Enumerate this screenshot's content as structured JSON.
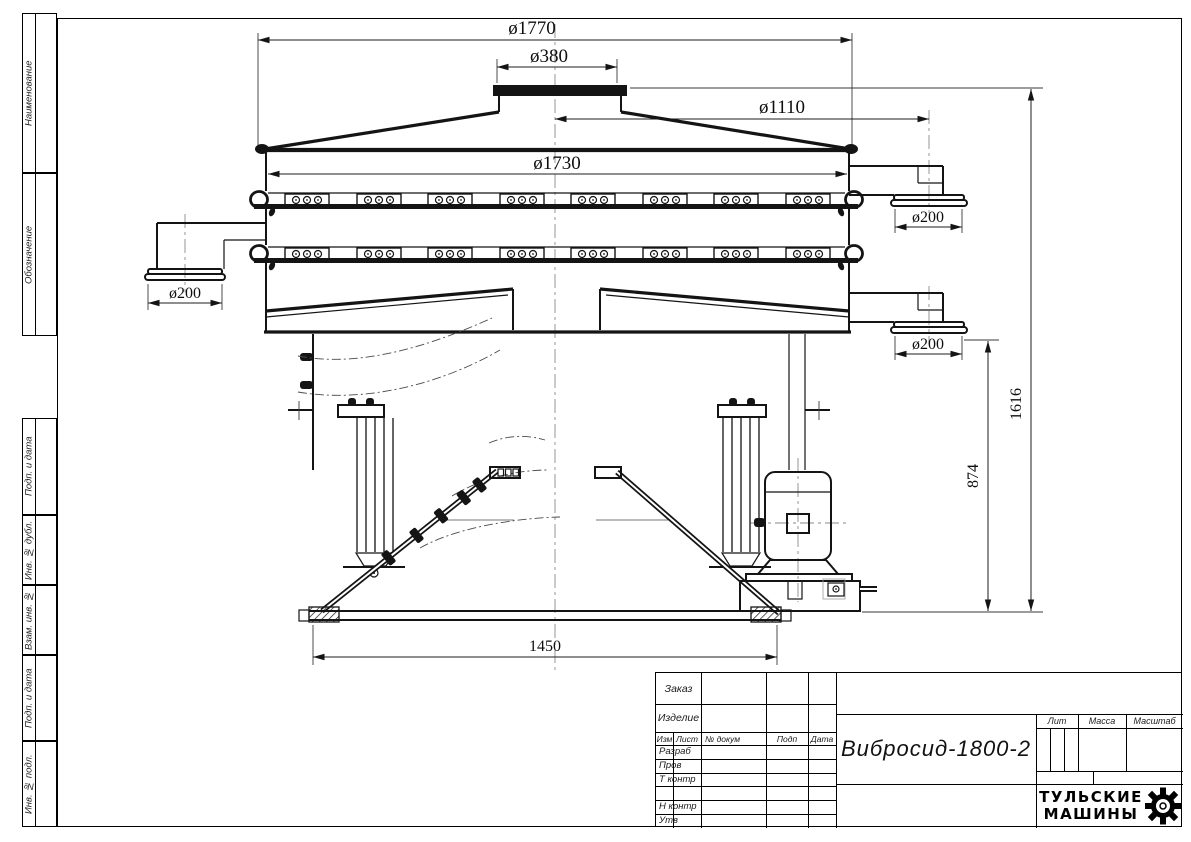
{
  "sidebar": {
    "labels": [
      "Наименование",
      "Обозначение",
      "Подп. и дата",
      "Инв. № дубл.",
      "Взам. инв. №",
      "Подп. и дата",
      "Инв. № подл."
    ]
  },
  "dims": {
    "top_flange": "ø1770",
    "inlet": "ø380",
    "outlet_circle": "ø1110",
    "body": "ø1730",
    "outlet_left": "ø200",
    "outlet_right_top": "ø200",
    "outlet_right_bottom": "ø200",
    "height_total": "1616",
    "height_base": "874",
    "base_width": "1450"
  },
  "title_block": {
    "order_label": "Заказ",
    "product_label": "Изделие",
    "cols": {
      "izm": "Изм",
      "list": "Лист",
      "dokum": "№ докум",
      "podp": "Подп",
      "data": "Дата"
    },
    "rows": [
      "Разраб",
      "Пров",
      "Т контр",
      "",
      "Н контр",
      "Утв"
    ],
    "doc_title": "Вибросид-1800-2",
    "lit": "Лит",
    "massa": "Масса",
    "masshtab": "Масштаб",
    "company_line1": "ТУЛЬСКИЕ",
    "company_line2": "МАШИНЫ"
  }
}
